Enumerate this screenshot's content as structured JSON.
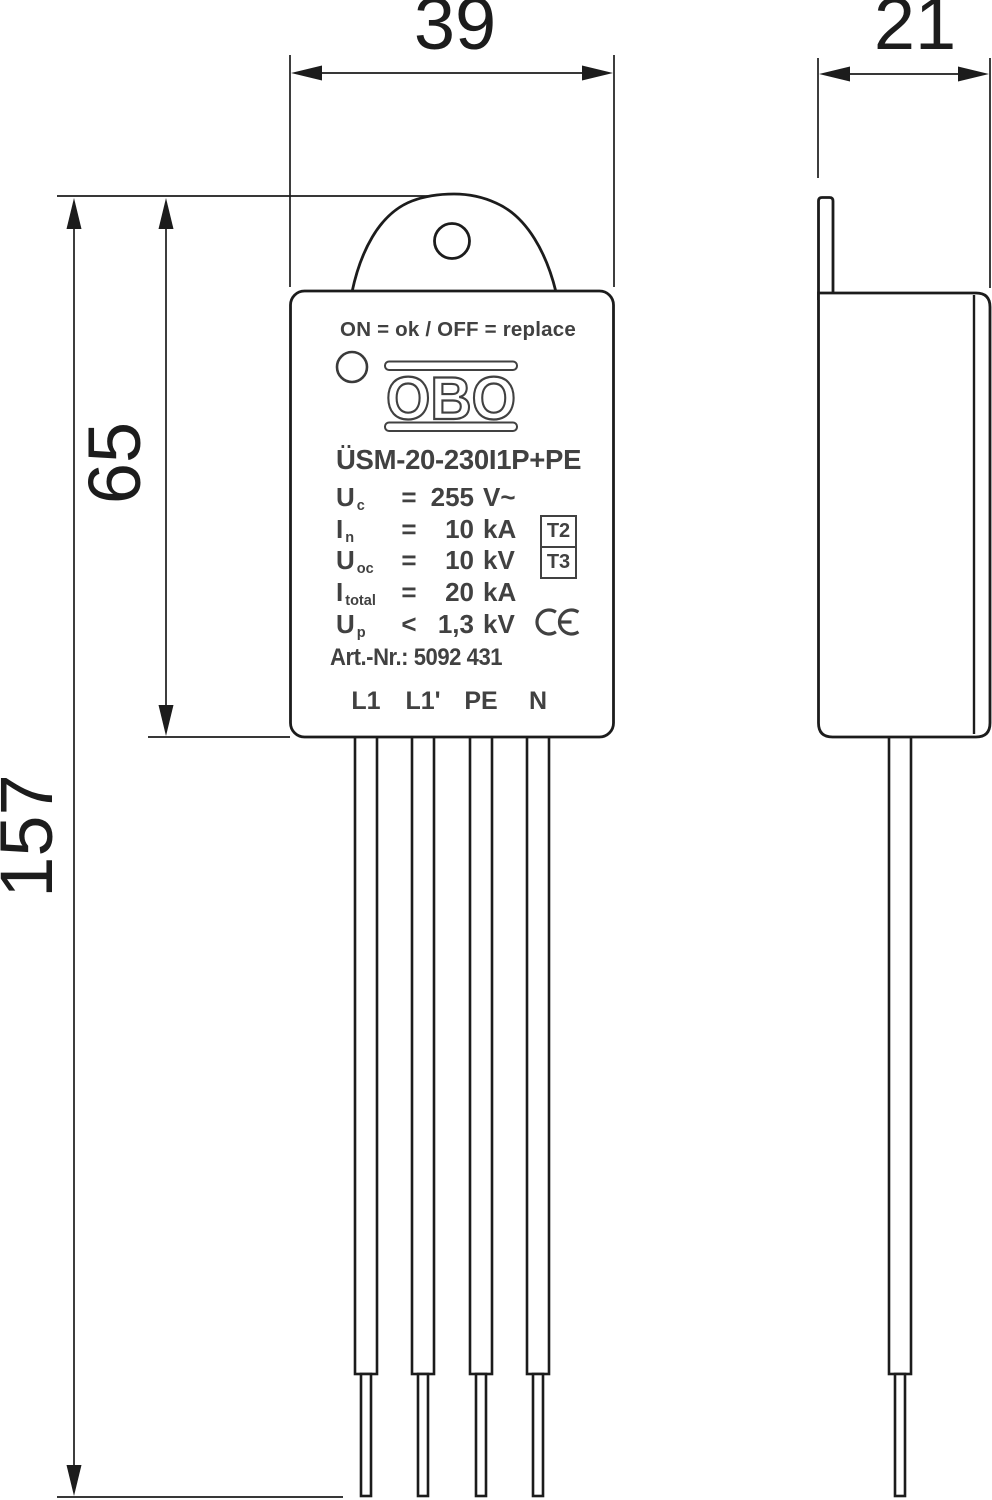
{
  "drawing": {
    "title_hint": "Surge protection device dimensional drawing, front and side view",
    "dimensions": {
      "front_width": "39",
      "side_depth": "21",
      "body_height": "65",
      "total_height": "157"
    },
    "label": {
      "status_line": "ON = ok  /  OFF = replace",
      "brand": "OBO",
      "model": "ÜSM-20-230I1P+PE",
      "specs": [
        {
          "sym": "U",
          "sub": "c",
          "op": "=",
          "value": "255",
          "unit": "V~"
        },
        {
          "sym": "I",
          "sub": "n",
          "op": "=",
          "value": "10",
          "unit": "kA"
        },
        {
          "sym": "U",
          "sub": "oc",
          "op": "=",
          "value": "10",
          "unit": "kV"
        },
        {
          "sym": "I",
          "sub": "total",
          "op": "=",
          "value": "20",
          "unit": "kA"
        },
        {
          "sym": "U",
          "sub": "p",
          "op": "<",
          "value": "1,3",
          "unit": "kV"
        }
      ],
      "type_badges": [
        "T2",
        "T3"
      ],
      "ce_mark": "CE",
      "art_nr": "Art.-Nr.: 5092 431",
      "terminals": [
        "L1",
        "L1'",
        "PE",
        "N"
      ]
    },
    "colors": {
      "line": "#1c1c1c",
      "label_ink": "#414141",
      "background": "#ffffff"
    }
  }
}
